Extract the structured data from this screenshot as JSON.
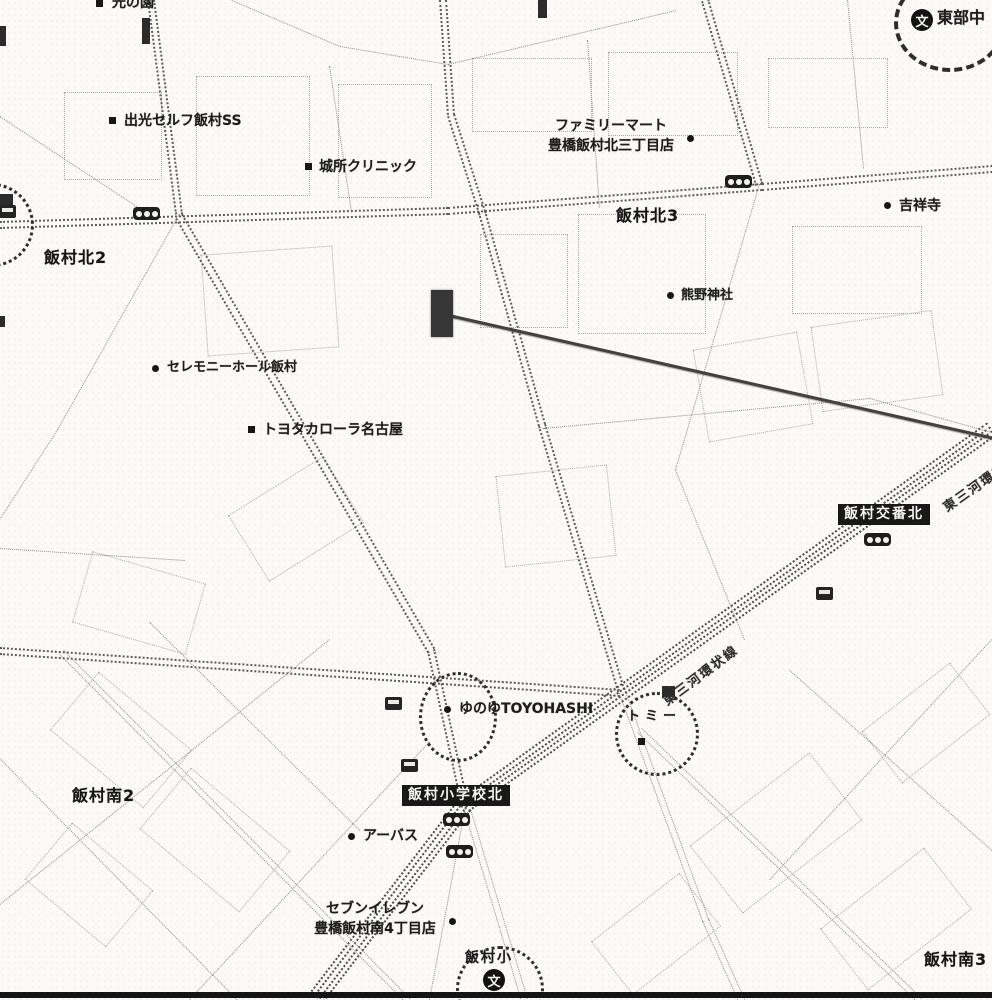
{
  "map": {
    "colors": {
      "paper": "#fbfaf7",
      "ink": "#1c1c1c",
      "road": "#8c8c8c",
      "road_major": "#5d5d5d",
      "road_expressway": "#4d4d4d",
      "circle": "#2e2e2e",
      "sign_bg": "#181818",
      "sign_text": "#f5f4f0"
    },
    "area_labels": [
      {
        "text": "飯村北2",
        "x": 44,
        "y": 246,
        "fs": 16
      },
      {
        "text": "飯村北3",
        "x": 616,
        "y": 204,
        "fs": 16
      },
      {
        "text": "飯村南2",
        "x": 72,
        "y": 784,
        "fs": 16
      },
      {
        "text": "飯村南3",
        "x": 924,
        "y": 948,
        "fs": 16
      }
    ],
    "poi_labels": [
      {
        "text": "出光セルフ飯村SS",
        "x": 124,
        "y": 111,
        "fs": 14
      },
      {
        "text": "城所クリニック",
        "x": 319,
        "y": 157,
        "fs": 14
      },
      {
        "text": "ファミリーマート\n豊橋飯村北三丁目店",
        "x": 527,
        "y": 116,
        "fs": 14,
        "align": "center",
        "w": 168
      },
      {
        "text": "吉祥寺",
        "x": 899,
        "y": 196,
        "fs": 14
      },
      {
        "text": "熊野神社",
        "x": 681,
        "y": 287,
        "fs": 13
      },
      {
        "text": "セレモニーホール飯村",
        "x": 167,
        "y": 359,
        "fs": 13
      },
      {
        "text": "トヨタカローラ名古屋",
        "x": 263,
        "y": 420,
        "fs": 14
      },
      {
        "text": "ゆのゆTOYOHASHI",
        "x": 459,
        "y": 699,
        "fs": 14
      },
      {
        "text": "トミー",
        "x": 627,
        "y": 708,
        "fs": 13,
        "ls": 5
      },
      {
        "text": "アーバス",
        "x": 363,
        "y": 826,
        "fs": 14
      },
      {
        "text": "セブンイレブン\n豊橋飯村南4丁目店",
        "x": 299,
        "y": 899,
        "fs": 14,
        "align": "center",
        "w": 152
      },
      {
        "text": "飯村小",
        "x": 465,
        "y": 948,
        "fs": 14,
        "ls": 2
      },
      {
        "text": "東部中",
        "x": 937,
        "y": 6,
        "fs": 16
      },
      {
        "text": "光の園",
        "x": 112,
        "y": -7,
        "fs": 14
      }
    ],
    "markers": [
      {
        "shape": "square",
        "x": 109,
        "y": 117
      },
      {
        "shape": "square",
        "x": 305,
        "y": 163
      },
      {
        "shape": "round",
        "x": 687,
        "y": 135
      },
      {
        "shape": "round",
        "x": 884,
        "y": 202
      },
      {
        "shape": "round",
        "x": 667,
        "y": 292
      },
      {
        "shape": "round",
        "x": 152,
        "y": 365
      },
      {
        "shape": "square",
        "x": 248,
        "y": 426
      },
      {
        "shape": "round",
        "x": 444,
        "y": 706
      },
      {
        "shape": "square",
        "x": 638,
        "y": 738
      },
      {
        "shape": "round",
        "x": 348,
        "y": 833
      },
      {
        "shape": "round",
        "x": 449,
        "y": 918
      },
      {
        "shape": "square",
        "x": 96,
        "y": 0
      }
    ],
    "signs": [
      {
        "text": "飯村交番北",
        "x": 838,
        "y": 504
      },
      {
        "text": "飯村小学校北",
        "x": 402,
        "y": 785
      }
    ],
    "road_labels": [
      {
        "text": "東三河環状線",
        "x": 664,
        "y": 692,
        "rot": -37,
        "fs": 13
      },
      {
        "text": "東三河環状線",
        "x": 944,
        "y": 498,
        "rot": -35,
        "fs": 13
      }
    ],
    "circles": [
      {
        "x": 419,
        "y": 672,
        "w": 72,
        "h": 84,
        "b": "3px dotted"
      },
      {
        "x": 615,
        "y": 692,
        "w": 78,
        "h": 78,
        "b": "3px dotted"
      },
      {
        "x": 456,
        "y": 946,
        "w": 82,
        "h": 80,
        "b": "3px dotted"
      },
      {
        "x": 894,
        "y": -26,
        "w": 104,
        "h": 90,
        "b": "4px dashed"
      },
      {
        "x": -50,
        "y": 183,
        "w": 78,
        "h": 78,
        "b": "3px dotted"
      }
    ],
    "school_glyph": "文",
    "school_icons": [
      {
        "x": 911,
        "y": 9
      },
      {
        "x": 483,
        "y": 969
      }
    ],
    "traffic_lights": [
      {
        "x": 133,
        "y": 207
      },
      {
        "x": 725,
        "y": 175
      },
      {
        "x": 864,
        "y": 533
      },
      {
        "x": 443,
        "y": 813
      },
      {
        "x": 446,
        "y": 845
      }
    ],
    "bus_stops": [
      {
        "x": 385,
        "y": 697
      },
      {
        "x": 401,
        "y": 759
      },
      {
        "x": 816,
        "y": 587
      },
      {
        "x": -1,
        "y": 205
      }
    ],
    "target": {
      "rect": {
        "x": 431,
        "y": 290,
        "w": 22,
        "h": 47
      },
      "line": {
        "x": 449,
        "y": 314,
        "len": 558,
        "angle": 12.7
      }
    },
    "smudges": [
      [
        0,
        26,
        6,
        20
      ],
      [
        0,
        194,
        13,
        11
      ],
      [
        0,
        316,
        5,
        11
      ],
      [
        142,
        18,
        8,
        26
      ],
      [
        538,
        0,
        9,
        18
      ],
      [
        662,
        686,
        13,
        11
      ]
    ],
    "roads": [
      [
        0,
        224,
        448,
        210,
        2,
        7,
        1
      ],
      [
        448,
        210,
        762,
        186,
        2,
        7,
        1
      ],
      [
        762,
        186,
        992,
        168,
        2,
        7,
        1
      ],
      [
        444,
        0,
        452,
        115,
        2,
        7,
        1
      ],
      [
        452,
        115,
        483,
        212,
        2,
        7,
        1
      ],
      [
        483,
        212,
        543,
        425,
        2,
        7,
        1
      ],
      [
        543,
        425,
        622,
        690,
        2,
        7,
        1
      ],
      [
        622,
        690,
        706,
        920,
        2,
        6,
        0
      ],
      [
        706,
        920,
        742,
        1000,
        2,
        6,
        0
      ],
      [
        992,
        430,
        465,
        806,
        4,
        5,
        2
      ],
      [
        465,
        806,
        316,
        1000,
        4,
        5,
        2
      ],
      [
        0,
        650,
        620,
        692,
        2,
        6,
        1
      ],
      [
        706,
        0,
        760,
        184,
        2,
        6,
        1
      ],
      [
        760,
        184,
        676,
        470,
        1,
        0,
        0
      ],
      [
        676,
        470,
        745,
        640,
        1,
        0,
        0
      ],
      [
        152,
        0,
        180,
        214,
        2,
        6,
        1
      ],
      [
        180,
        214,
        58,
        430,
        1,
        0,
        0
      ],
      [
        58,
        430,
        0,
        520,
        1,
        0,
        0
      ],
      [
        0,
        116,
        152,
        216,
        1,
        0,
        0
      ],
      [
        180,
        216,
        432,
        650,
        2,
        6,
        1
      ],
      [
        432,
        650,
        466,
        806,
        2,
        6,
        1
      ],
      [
        466,
        806,
        430,
        1000,
        1,
        0,
        0
      ],
      [
        468,
        810,
        525,
        1000,
        2,
        6,
        0
      ],
      [
        232,
        0,
        340,
        46,
        1,
        0,
        0
      ],
      [
        340,
        46,
        448,
        64,
        1,
        0,
        0
      ],
      [
        448,
        64,
        676,
        10,
        1,
        0,
        0
      ],
      [
        543,
        428,
        870,
        398,
        1,
        0,
        0
      ],
      [
        870,
        398,
        992,
        432,
        1,
        0,
        0
      ],
      [
        640,
        730,
        920,
        1000,
        2,
        5,
        0
      ],
      [
        790,
        670,
        992,
        850,
        1,
        0,
        0
      ],
      [
        992,
        640,
        770,
        880,
        1,
        0,
        0
      ],
      [
        0,
        758,
        238,
        1000,
        1,
        0,
        0
      ],
      [
        62,
        652,
        408,
        1000,
        2,
        5,
        0
      ],
      [
        150,
        622,
        360,
        830,
        1,
        0,
        0
      ],
      [
        330,
        640,
        0,
        905,
        1,
        0,
        0
      ],
      [
        430,
        742,
        190,
        1000,
        1,
        0,
        0
      ],
      [
        330,
        66,
        352,
        212,
        1,
        0,
        0
      ],
      [
        588,
        40,
        600,
        208,
        1,
        0,
        0
      ],
      [
        848,
        0,
        864,
        168,
        1,
        0,
        0
      ],
      [
        0,
        548,
        185,
        560,
        1,
        0,
        0
      ]
    ],
    "blocks": [
      [
        196,
        76,
        112,
        118,
        0
      ],
      [
        338,
        84,
        92,
        112,
        0
      ],
      [
        472,
        58,
        118,
        72,
        0
      ],
      [
        608,
        52,
        128,
        82,
        0
      ],
      [
        768,
        58,
        118,
        68,
        0
      ],
      [
        64,
        92,
        96,
        86,
        0
      ],
      [
        204,
        250,
        130,
        100,
        -4
      ],
      [
        480,
        234,
        86,
        92,
        0
      ],
      [
        578,
        214,
        126,
        118,
        0
      ],
      [
        792,
        226,
        128,
        86,
        0
      ],
      [
        700,
        340,
        104,
        92,
        -10
      ],
      [
        816,
        318,
        120,
        84,
        -8
      ],
      [
        500,
        470,
        110,
        90,
        -6
      ],
      [
        240,
        480,
        110,
        76,
        -32
      ],
      [
        80,
        566,
        116,
        72,
        16
      ],
      [
        60,
        702,
        120,
        74,
        40
      ],
      [
        150,
        800,
        128,
        78,
        40
      ],
      [
        36,
        848,
        104,
        72,
        40
      ],
      [
        700,
        790,
        150,
        84,
        -38
      ],
      [
        830,
        880,
        130,
        76,
        -38
      ],
      [
        600,
        900,
        110,
        66,
        -38
      ],
      [
        870,
        690,
        110,
        64,
        -38
      ]
    ]
  }
}
